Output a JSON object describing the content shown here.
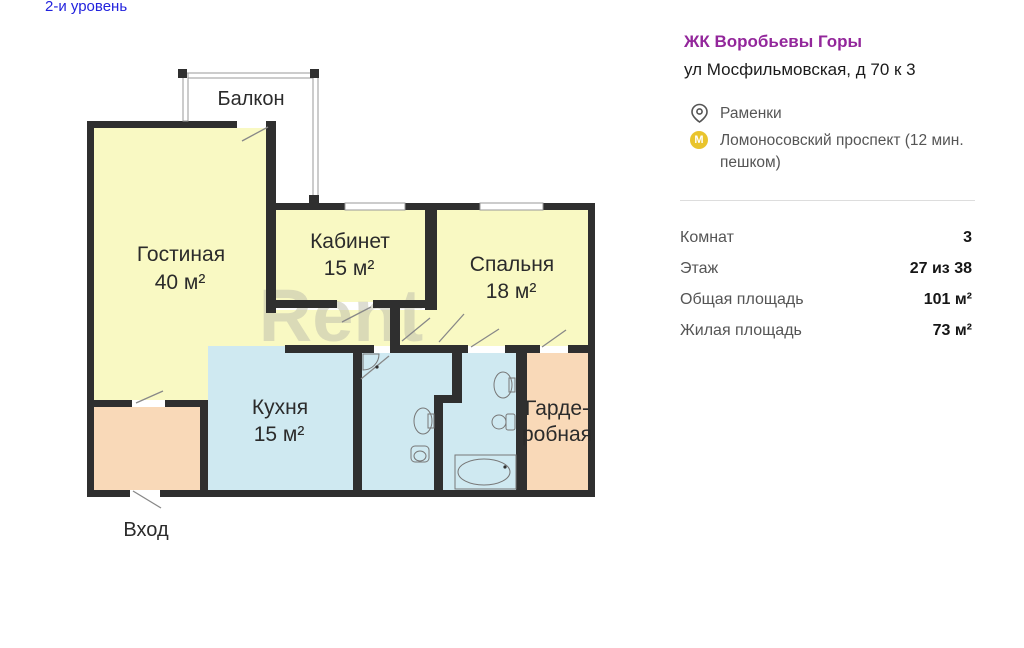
{
  "page": {
    "level_link": "2-и уровень"
  },
  "plan": {
    "watermark": "Rent",
    "balcony_label": "Балкон",
    "entrance_label": "Вход",
    "rooms": {
      "living": {
        "name": "Гостиная",
        "area": "40 м²"
      },
      "office": {
        "name": "Кабинет",
        "area": "15 м²"
      },
      "bedroom": {
        "name": "Спальня",
        "area": "18 м²"
      },
      "kitchen": {
        "name": "Кухня",
        "area": "15 м²"
      },
      "wardrobe": {
        "name_line1": "Гарде-",
        "name_line2": "робная"
      }
    }
  },
  "listing": {
    "complex_name": "ЖК Воробьевы Горы",
    "address": "ул Мосфильмовская, д 70 к 3",
    "district": "Раменки",
    "metro": "Ломоносовский проспект (12 мин. пешком)",
    "details": [
      {
        "label": "Комнат",
        "value": "3"
      },
      {
        "label": "Этаж",
        "value": "27 из 38"
      },
      {
        "label": "Общая площадь",
        "value": "101 м²"
      },
      {
        "label": "Жилая площадь",
        "value": "73 м²"
      }
    ]
  },
  "colors": {
    "accent_purple": "#93279B",
    "link_blue": "#2222DD",
    "metro_yellow": "#E9C42D",
    "room_yellow": "#F9F9C3",
    "wet_room_blue": "#CFE9F1",
    "hall_peach": "#F9D9B8",
    "wall_dark": "#2F2F2F"
  }
}
